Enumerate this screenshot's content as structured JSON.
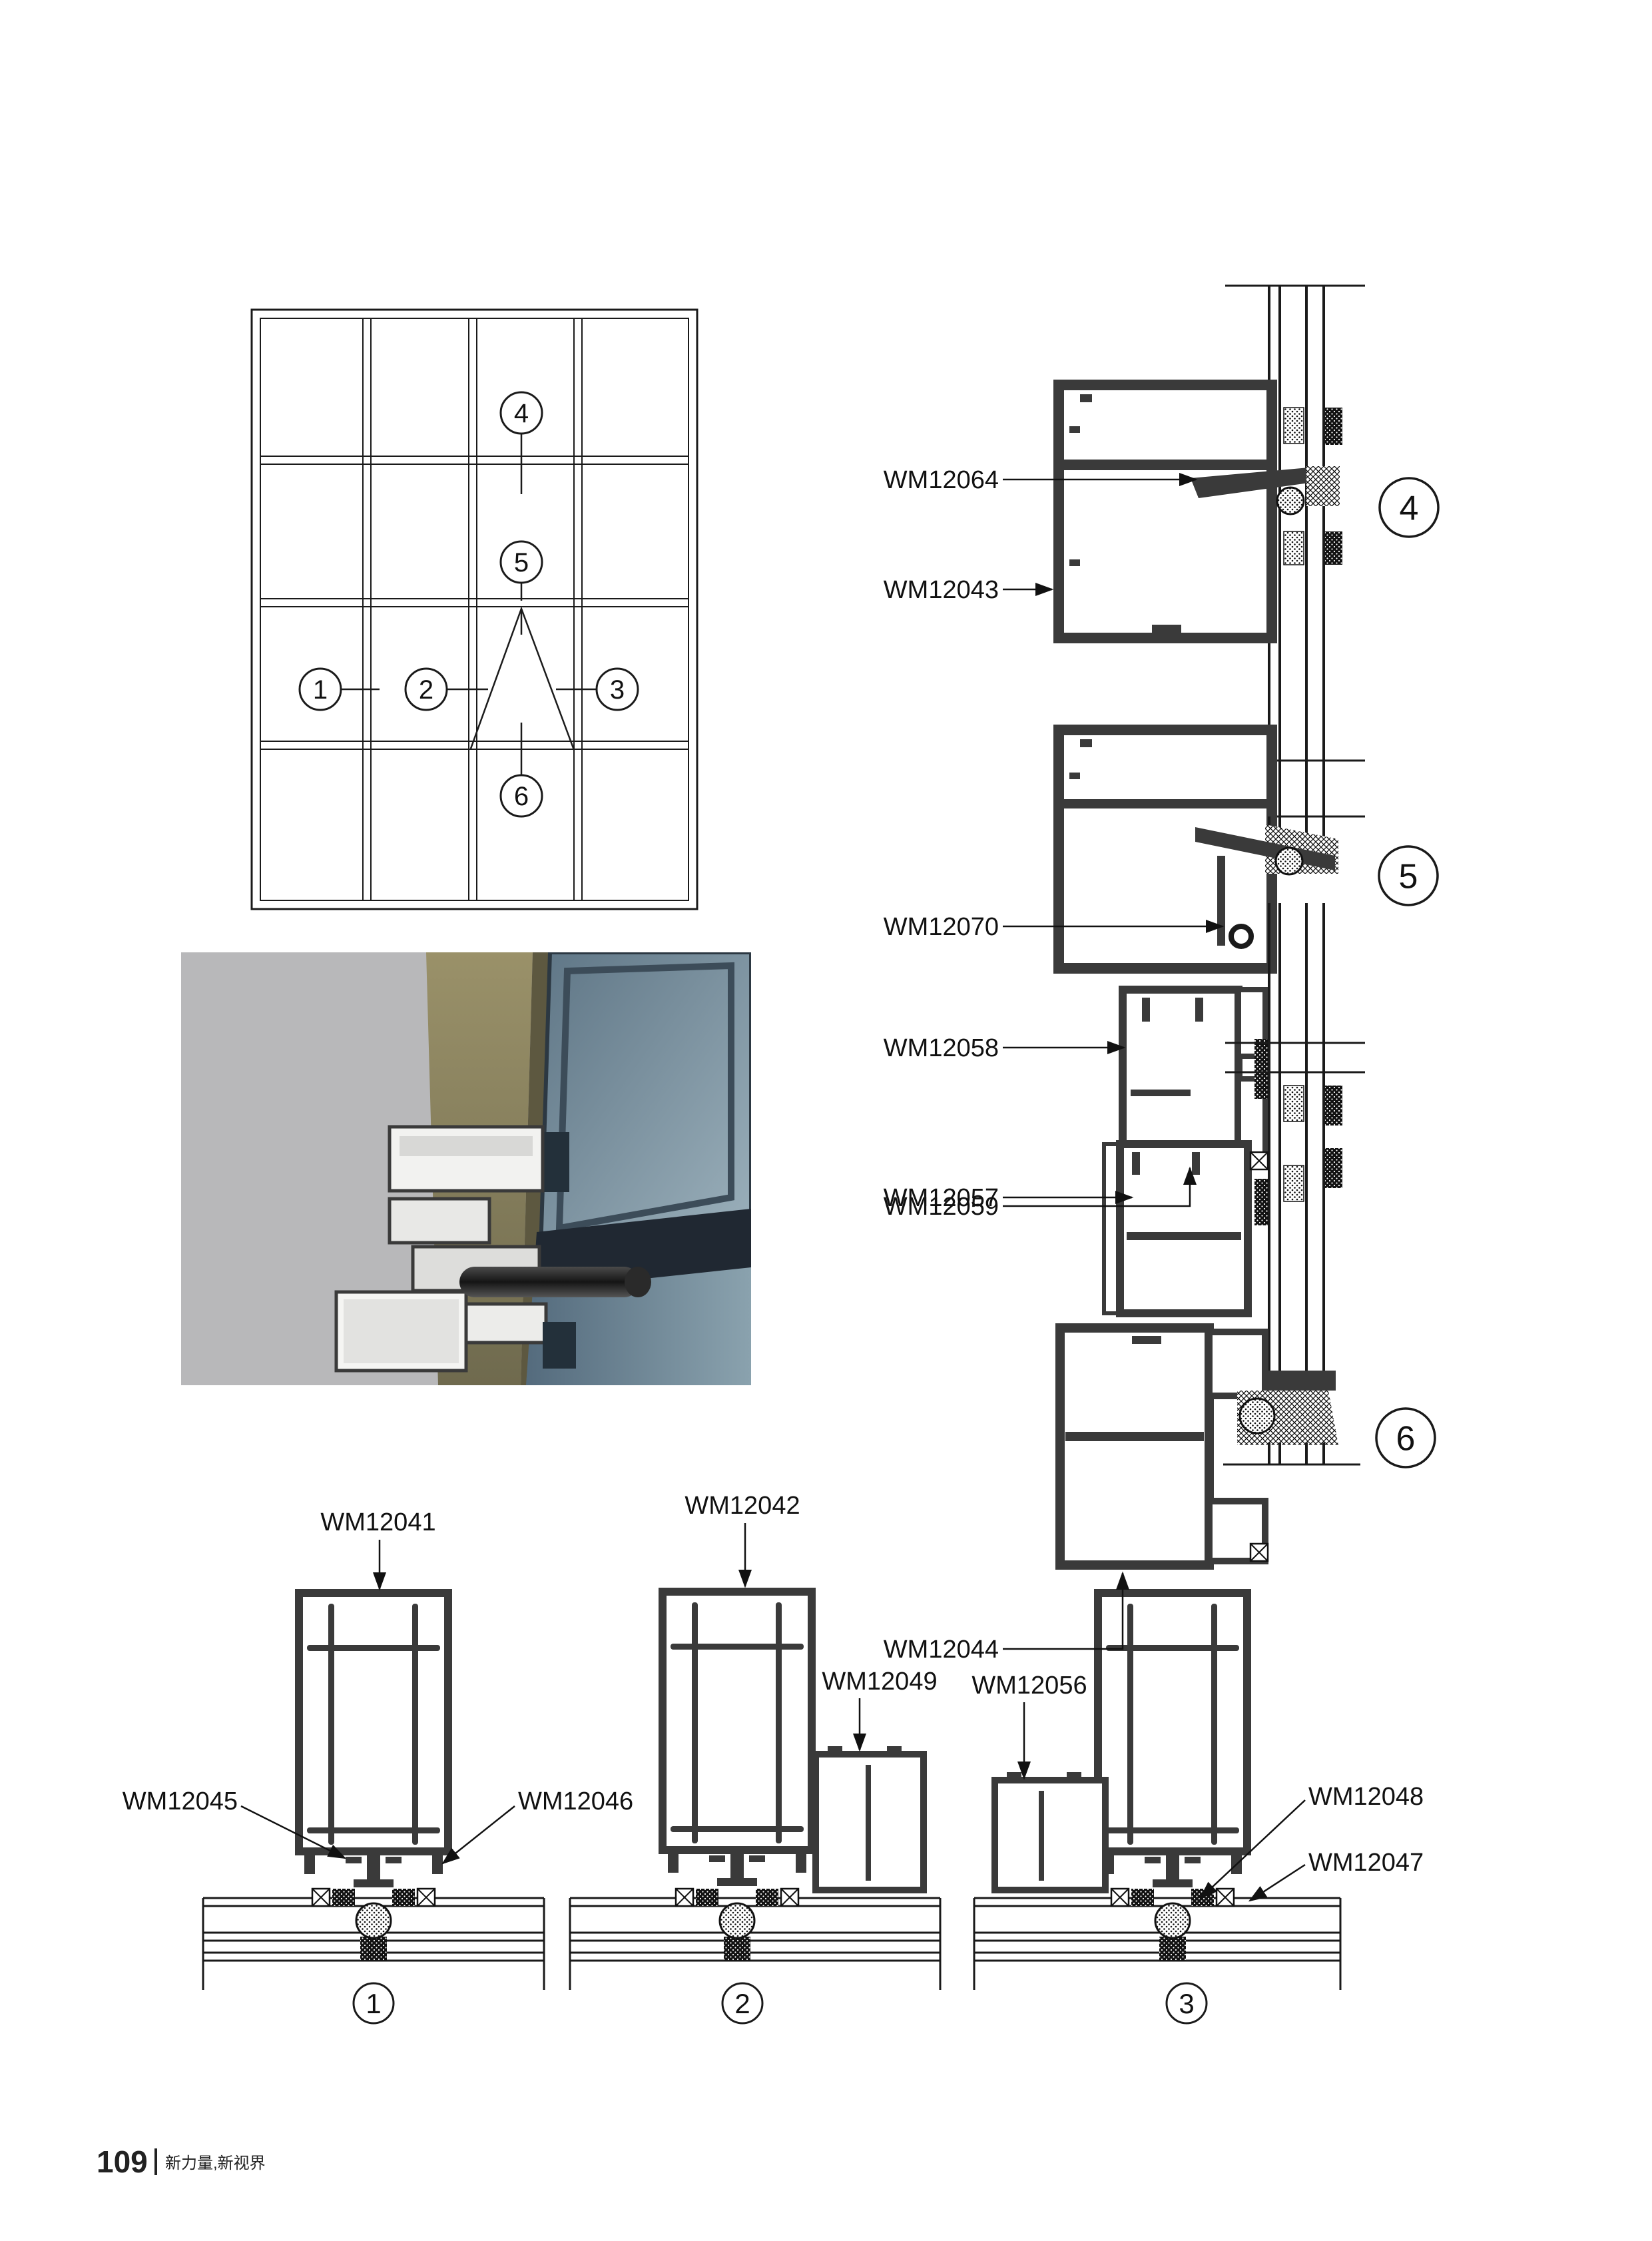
{
  "footer": {
    "page_number": "109",
    "slogan": "新力量,新视界"
  },
  "elevation": {
    "callouts": {
      "c1": "1",
      "c2": "2",
      "c3": "3",
      "c4": "4",
      "c5": "5",
      "c6": "6"
    }
  },
  "details": {
    "v4": {
      "callout": "4",
      "part1": "WM12064",
      "part2": "WM12043"
    },
    "v5": {
      "callout": "5",
      "part1": "WM12070",
      "part2": "WM12058",
      "part3": "WM12059"
    },
    "v6": {
      "callout": "6",
      "part1": "WM12057",
      "part2": "WM12044"
    },
    "h1": {
      "callout": "1",
      "top": "WM12041",
      "left": "WM12045",
      "right": "WM12046"
    },
    "h2": {
      "callout": "2",
      "top": "WM12042",
      "side": "WM12049"
    },
    "h3": {
      "callout": "3",
      "top": "WM12056",
      "right1": "WM12048",
      "right2": "WM12047"
    }
  },
  "colors": {
    "line": "#1a1a1a",
    "profile_fill": "#3a3a3a",
    "photo_background": "#b8b8ba",
    "photo_bronze": "#8a8160",
    "photo_glass": "#7d93a4"
  }
}
